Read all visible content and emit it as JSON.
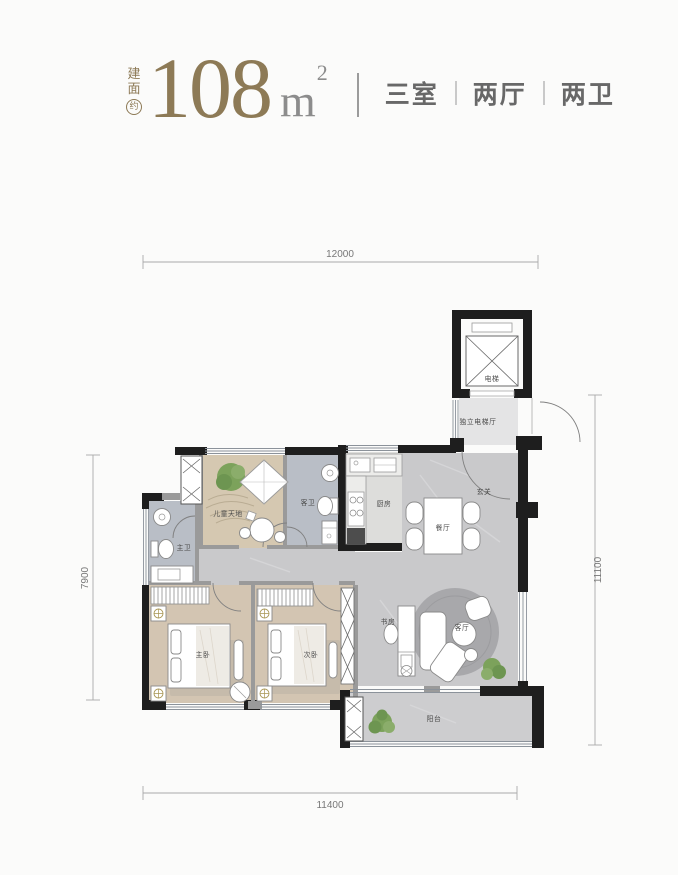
{
  "header": {
    "area_label_chars": [
      "建",
      "面"
    ],
    "area_label_circled": "约",
    "area_value": "108",
    "area_unit": "m",
    "area_unit_sup": "2",
    "specs": [
      {
        "label": "三室"
      },
      {
        "label": "两厅"
      },
      {
        "label": "两卫"
      }
    ],
    "colors": {
      "accent_brown": "#8d7a56",
      "unit_gray": "#8c8c8c",
      "spec_gray": "#686868"
    }
  },
  "dimensions": {
    "top": "12000",
    "bottom": "11400",
    "left": "7900",
    "right": "11100"
  },
  "rooms": {
    "elevator": "电梯",
    "elevator_hall": "独立电梯厅",
    "entry": "玄关",
    "kitchen": "厨房",
    "dining": "餐厅",
    "living": "客厅",
    "study": "书房",
    "balcony": "阳台",
    "kids_area": "儿童天地",
    "guest_bath": "客卫",
    "master_bath": "主卫",
    "master_bed": "主卧",
    "second_bed": "次卧"
  },
  "palette": {
    "wall_black": "#1e1e1e",
    "partition_gray": "#9a9a9a",
    "floor_stone": "#c9c9cb",
    "floor_wood": "#d3c5b2",
    "floor_bath": "#b9bec6",
    "floor_kids": "#d5c8b1",
    "floor_balcony": "#cdcdcf",
    "plant_green": "#7ca25b",
    "rug_gray": "#a8a8ab",
    "fixture_gold": "#a89552"
  }
}
